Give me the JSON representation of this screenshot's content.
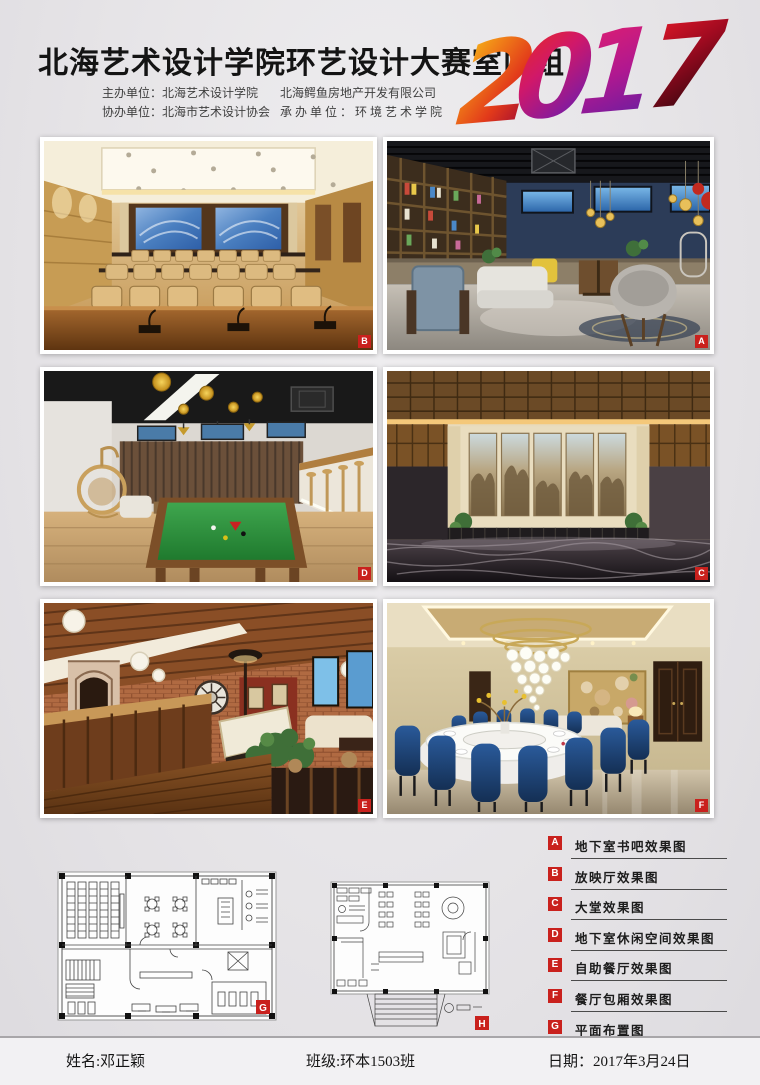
{
  "header": {
    "title": "北海艺术设计学院环艺设计大赛室内组",
    "year_digits": [
      "2",
      "0",
      "1",
      "7"
    ],
    "organizers": {
      "host": "主办单位：北海艺术设计学院",
      "host_company": "北海鳄鱼房地产开发有限公司",
      "co_organizer": "协办单位：北海市艺术设计协会",
      "undertaker": "承办单位：环境艺术学院"
    }
  },
  "photos": [
    {
      "tag": "B"
    },
    {
      "tag": "A"
    },
    {
      "tag": "D"
    },
    {
      "tag": "C"
    },
    {
      "tag": "E"
    },
    {
      "tag": "F"
    }
  ],
  "plans": [
    {
      "tag": "G"
    },
    {
      "tag": "H"
    }
  ],
  "legend": {
    "items": [
      {
        "letter": "A",
        "label": "地下室书吧效果图"
      },
      {
        "letter": "B",
        "label": "放映厅效果图"
      },
      {
        "letter": "C",
        "label": "大堂效果图"
      },
      {
        "letter": "D",
        "label": "地下室休闲空间效果图"
      },
      {
        "letter": "E",
        "label": "自助餐厅效果图"
      },
      {
        "letter": "F",
        "label": "餐厅包厢效果图"
      },
      {
        "letter": "G",
        "label": "平面布置图"
      },
      {
        "letter": "H",
        "label": "平面布置图"
      }
    ]
  },
  "footer": {
    "name": "姓名:邓正颖",
    "class": "班级:环本1503班",
    "date": "日期：2017年3月24日"
  },
  "colors": {
    "accent_red": "#c9211d",
    "background": "#e6e4e7"
  }
}
